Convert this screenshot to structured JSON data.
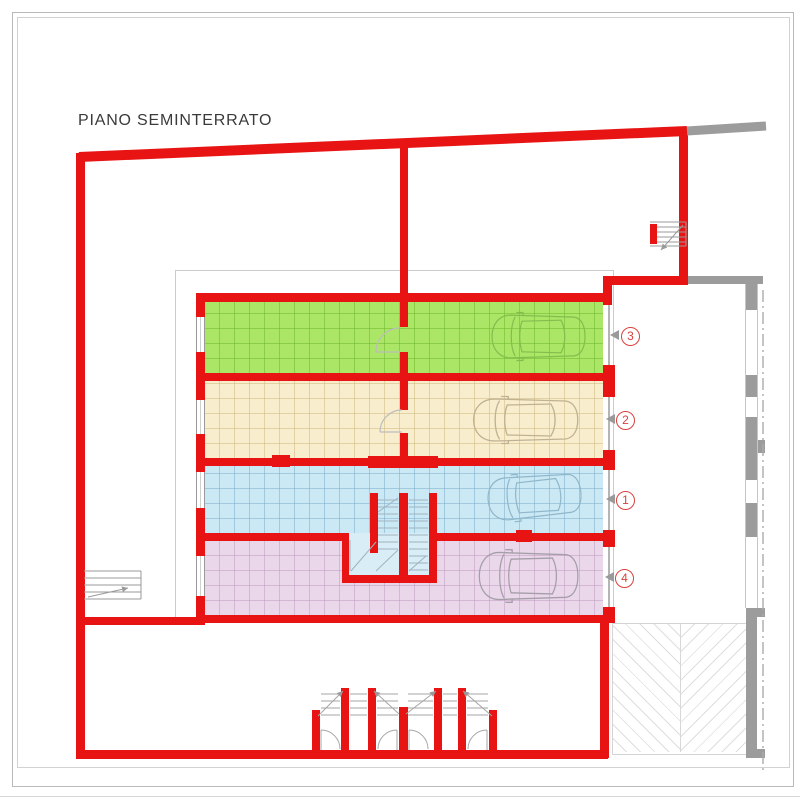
{
  "title": "PIANO SEMINTERRATO",
  "garages": [
    {
      "number": "3",
      "floor_color": "#abe667",
      "row": "top"
    },
    {
      "number": "2",
      "floor_color": "#f8eecd",
      "row": "second"
    },
    {
      "number": "1",
      "floor_color": "#cbe8f5",
      "row": "third"
    },
    {
      "number": "4",
      "floor_color": "#ead8ea",
      "row": "bottom"
    }
  ],
  "colors": {
    "wall_red": "#e81414",
    "context_wall_gray": "#9c9c9c",
    "marker_red": "#d9413d",
    "frame_gray": "#b9b9b9"
  },
  "icons": {
    "entry_arrows": "direction-arrow-icon",
    "cars": "car-icon",
    "stairs": "stairs-icon"
  }
}
